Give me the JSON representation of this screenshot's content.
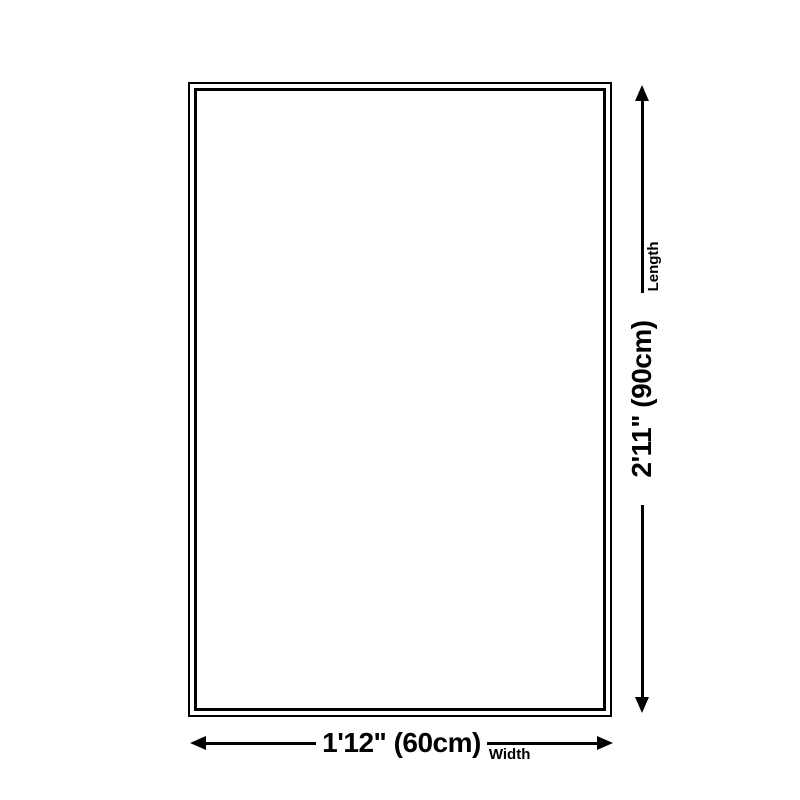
{
  "diagram": {
    "type": "product-size-diagram",
    "width": {
      "value": "1'12\" (60cm)",
      "label": "Width"
    },
    "length": {
      "value": "2'11\" (90cm)",
      "label": "Length"
    },
    "colors": {
      "line": "#000000",
      "background": "#ffffff",
      "text": "#000000"
    }
  }
}
